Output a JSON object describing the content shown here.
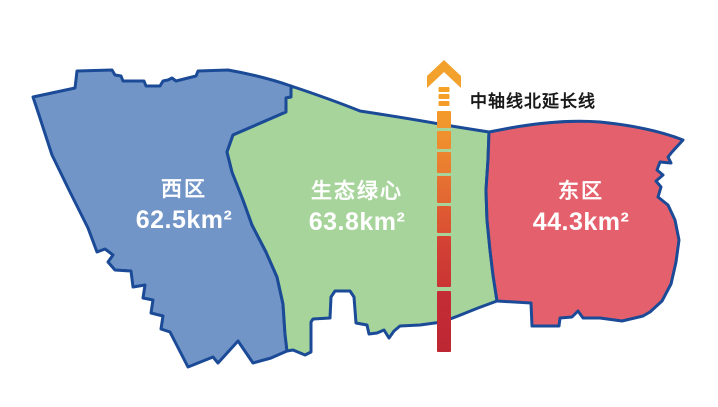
{
  "map": {
    "background": "#ffffff",
    "outline_color": "#1b4a97",
    "label_color": "#ffffff",
    "regions": [
      {
        "name": "西区",
        "area": "62.5km²",
        "fill": "#7295c8"
      },
      {
        "name": "生态绿心",
        "area": "63.8km²",
        "fill": "#a6d49b"
      },
      {
        "name": "东区",
        "area": "44.3km²",
        "fill": "#e4606c"
      }
    ]
  },
  "axis": {
    "label": "中轴线北延长线",
    "label_color": "#1a1a1a",
    "arrow_color": "#f2a12d",
    "dashes": [
      {
        "top": 87,
        "h": 5,
        "w": 11,
        "c1": "#f6a227",
        "c2": "#f6a227"
      },
      {
        "top": 94,
        "h": 5,
        "w": 11,
        "c1": "#f5a028",
        "c2": "#f5a028"
      },
      {
        "top": 101,
        "h": 5,
        "w": 11,
        "c1": "#f49d29",
        "c2": "#f49d29"
      },
      {
        "top": 111,
        "h": 17,
        "w": 14,
        "c1": "#f39a2b",
        "c2": "#f1952d"
      },
      {
        "top": 131,
        "h": 18,
        "w": 14,
        "c1": "#f0922d",
        "c2": "#ee8a2f"
      },
      {
        "top": 152,
        "h": 21,
        "w": 14,
        "c1": "#ec8430",
        "c2": "#e97b30"
      },
      {
        "top": 176,
        "h": 27,
        "w": 14,
        "c1": "#e67231",
        "c2": "#e26632"
      },
      {
        "top": 206,
        "h": 27,
        "w": 14,
        "c1": "#df5c32",
        "c2": "#da5133"
      },
      {
        "top": 236,
        "h": 51,
        "w": 14,
        "c1": "#d44434",
        "c2": "#ca3434"
      },
      {
        "top": 291,
        "h": 61,
        "w": 14,
        "c1": "#c52d35",
        "c2": "#bd2733"
      }
    ]
  }
}
